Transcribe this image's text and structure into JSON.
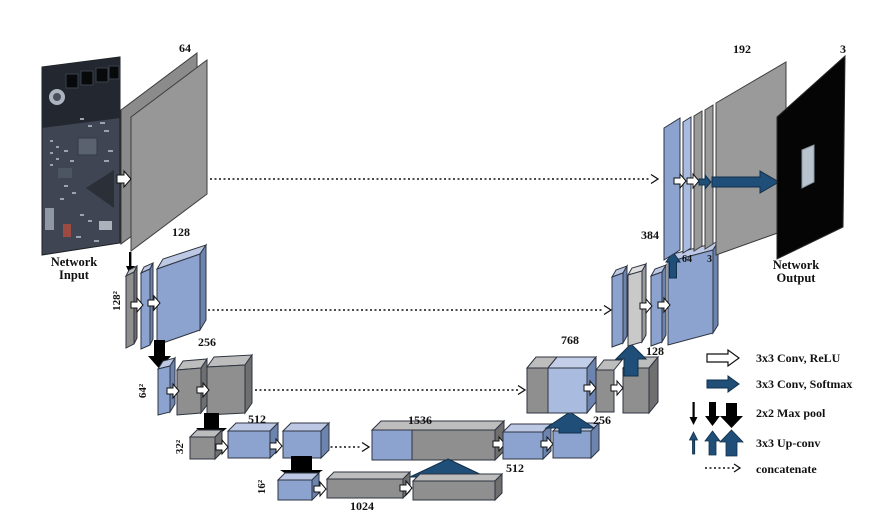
{
  "figure": {
    "io": {
      "input_label": "Network Input",
      "output_label": "Network Output",
      "output_channels": "3"
    },
    "blocks": {
      "enc1": {
        "channels": "64"
      },
      "enc2": {
        "channels": "128",
        "size": "128²"
      },
      "enc3": {
        "channels": "256",
        "size": "64²"
      },
      "enc4": {
        "channels": "512",
        "size": "32²"
      },
      "bottleneck": {
        "channels": "1024",
        "size": "16²"
      },
      "dec4": {
        "channels": "1536",
        "mid": "512",
        "up": "256"
      },
      "dec3": {
        "channels": "768",
        "up": "128"
      },
      "dec2": {
        "channels": "384",
        "up": "64",
        "up_out": "3"
      },
      "dec1": {
        "channels": "192"
      }
    },
    "legend": {
      "items": [
        {
          "icon": "conv-relu-arrow-icon",
          "label": "3x3 Conv, ReLU"
        },
        {
          "icon": "conv-softmax-arrow-icon",
          "label": "3x3 Conv, Softmax"
        },
        {
          "icon": "maxpool-arrows-icon",
          "label": "2x2 Max pool"
        },
        {
          "icon": "upconv-arrows-icon",
          "label": "3x3 Up-conv"
        },
        {
          "icon": "concatenate-arrow-icon",
          "label": "concatenate"
        }
      ]
    },
    "colors": {
      "gray_face": "#8f8f8f",
      "blue_face": "#8ca3cf",
      "dark_blue_arrow": "#1f4e79",
      "black": "#000000"
    }
  }
}
